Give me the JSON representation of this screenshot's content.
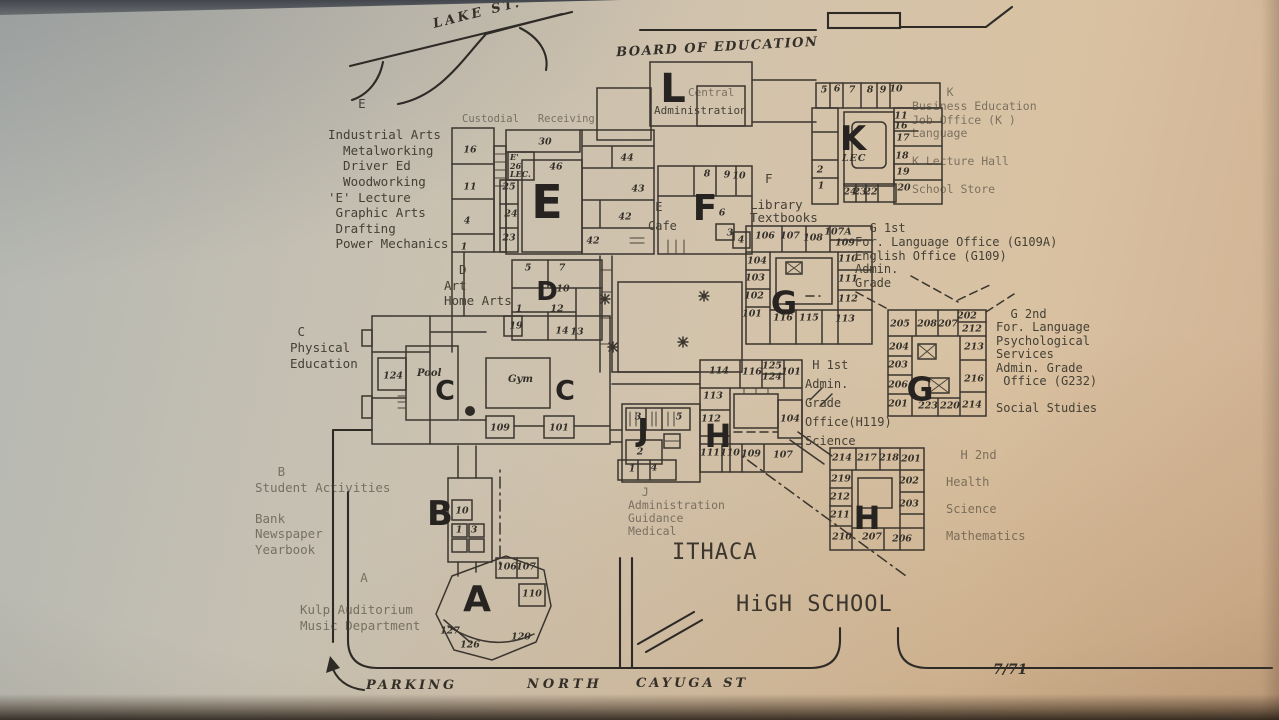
{
  "meta": {
    "date_stamp": "7/71",
    "map_subject": "Ithaca High School campus map"
  },
  "colors": {
    "paper": "#d3c3ab",
    "ink": "#3a352e",
    "shadow": "#2e2b27"
  },
  "annotations": [
    {
      "id": "lake-st-label",
      "x": 432,
      "y": 6,
      "size": 13,
      "ls": 3,
      "rot": -14,
      "cls": "hand",
      "lines": [
        "LAKE ST."
      ]
    },
    {
      "id": "board-of-education-label",
      "x": 616,
      "y": 40,
      "size": 13,
      "ls": 1.5,
      "rot": -3,
      "cls": "hand",
      "lines": [
        "BOARD OF EDUCATION"
      ]
    },
    {
      "id": "l-building-sublabel-top",
      "x": 688,
      "y": 86,
      "size": 11,
      "cls": "type faint",
      "lines": [
        "Central"
      ]
    },
    {
      "id": "l-building-sublabel-bottom",
      "x": 654,
      "y": 104,
      "size": 11,
      "cls": "type",
      "lines": [
        "Administration"
      ]
    },
    {
      "id": "custodial-label",
      "x": 462,
      "y": 113,
      "size": 10.5,
      "cls": "type faint",
      "lines": [
        "Custodial   Receiving"
      ]
    },
    {
      "id": "e-wing-legend",
      "x": 328,
      "y": 96,
      "size": 12.5,
      "lh": 15.6,
      "cls": "type",
      "lines": [
        "    E",
        "",
        "Industrial Arts",
        "  Metalworking",
        "  Driver Ed",
        "  Woodworking",
        "'E' Lecture",
        " Graphic Arts",
        " Drafting",
        " Power Mechanics"
      ]
    },
    {
      "id": "cafe-label",
      "x": 648,
      "y": 198,
      "size": 12,
      "lh": 19,
      "cls": "type",
      "lines": [
        " E",
        "Cafe"
      ]
    },
    {
      "id": "library-legend",
      "x": 750,
      "y": 172,
      "size": 12.5,
      "lh": 13,
      "cls": "type",
      "lines": [
        "  F",
        "",
        "Library",
        "Textbooks"
      ]
    },
    {
      "id": "k-legend",
      "x": 912,
      "y": 86,
      "size": 11.5,
      "lh": 13.8,
      "cls": "type faint",
      "lines": [
        "     K",
        "Business Education",
        "Job Office (K )",
        "Language",
        "",
        "K Lecture Hall",
        "",
        "School Store"
      ]
    },
    {
      "id": "g-first-legend",
      "x": 855,
      "y": 222,
      "size": 12,
      "lh": 13.8,
      "cls": "type",
      "lines": [
        "  G 1st",
        "For. Language Office (G109A)",
        "English Office (G109)",
        "Admin.",
        "Grade"
      ]
    },
    {
      "id": "g-second-legend",
      "x": 996,
      "y": 308,
      "size": 12,
      "lh": 13.4,
      "cls": "type",
      "lines": [
        "  G 2nd",
        "For. Language",
        "Psychological",
        "Services",
        "Admin. Grade",
        " Office (G232)",
        "",
        "Social Studies"
      ]
    },
    {
      "id": "h-first-legend",
      "x": 805,
      "y": 356,
      "size": 12,
      "lh": 19,
      "cls": "type",
      "lines": [
        " H 1st",
        "Admin.",
        "Grade",
        "Office(H119)",
        "Science"
      ]
    },
    {
      "id": "h-second-legend",
      "x": 946,
      "y": 442,
      "size": 12,
      "lh": 27,
      "cls": "type faint",
      "lines": [
        "  H 2nd",
        "Health",
        "Science",
        "Mathematics"
      ]
    },
    {
      "id": "c-legend",
      "x": 290,
      "y": 324,
      "size": 12.5,
      "lh": 16,
      "cls": "type",
      "lines": [
        " C",
        "Physical",
        "Education"
      ]
    },
    {
      "id": "d-legend",
      "x": 444,
      "y": 262,
      "size": 12.5,
      "lh": 15.5,
      "cls": "type",
      "lines": [
        "  D",
        "Art",
        "Home Arts"
      ]
    },
    {
      "id": "b-legend",
      "x": 255,
      "y": 464,
      "size": 12.5,
      "lh": 15.5,
      "cls": "type faint",
      "lines": [
        "   B",
        "Student Activities",
        "",
        "Bank",
        "Newspaper",
        "Yearbook"
      ]
    },
    {
      "id": "a-legend",
      "x": 300,
      "y": 570,
      "size": 12.5,
      "lh": 16,
      "cls": "type faint",
      "lines": [
        "        A",
        "",
        "Kulp Auditorium",
        "Music Department"
      ]
    },
    {
      "id": "j-legend",
      "x": 628,
      "y": 486,
      "size": 11.5,
      "lh": 13,
      "cls": "type faint",
      "lines": [
        "  J",
        "Administration",
        "Guidance",
        "Medical"
      ]
    },
    {
      "id": "school-name-line1",
      "x": 672,
      "y": 540,
      "size": 22,
      "ls": 1,
      "cls": "big",
      "lines": [
        "ITHACA"
      ]
    },
    {
      "id": "school-name-line2",
      "x": 736,
      "y": 592,
      "size": 22,
      "ls": 1,
      "cls": "big",
      "lines": [
        "HiGH SCHOOL"
      ]
    },
    {
      "id": "parking-label",
      "x": 366,
      "y": 678,
      "size": 13,
      "ls": 3,
      "cls": "hand",
      "lines": [
        "PARKING"
      ]
    },
    {
      "id": "north-label",
      "x": 527,
      "y": 677,
      "size": 13,
      "ls": 4,
      "cls": "hand",
      "lines": [
        "NORTH"
      ]
    },
    {
      "id": "cayuga-st-label",
      "x": 636,
      "y": 676,
      "size": 13,
      "ls": 3,
      "cls": "hand",
      "lines": [
        "CAYUGA ST"
      ]
    },
    {
      "id": "date-stamp",
      "x": 993,
      "y": 662,
      "size": 14,
      "cls": "hand",
      "lines": [
        "7/71"
      ]
    },
    {
      "id": "pool-label",
      "x": 417,
      "y": 368,
      "size": 10,
      "cls": "hand",
      "lines": [
        "Pool"
      ]
    },
    {
      "id": "gym-label",
      "x": 508,
      "y": 374,
      "size": 10,
      "cls": "hand",
      "lines": [
        "Gym"
      ]
    },
    {
      "id": "e-lecture-room-label",
      "x": 510,
      "y": 153,
      "size": 8,
      "lh": 8.5,
      "cls": "hand",
      "lines": [
        "E'",
        "26",
        "LEC."
      ]
    },
    {
      "id": "k-lecture-room-label",
      "x": 842,
      "y": 153,
      "size": 9.5,
      "ls": 1,
      "cls": "hand",
      "lines": [
        "LEC"
      ]
    }
  ],
  "letters": [
    {
      "t": "L",
      "x": 673,
      "y": 89,
      "s": 40
    },
    {
      "t": "E",
      "x": 547,
      "y": 202,
      "s": 46
    },
    {
      "t": "F",
      "x": 705,
      "y": 209,
      "s": 36
    },
    {
      "t": "K",
      "x": 853,
      "y": 139,
      "s": 34
    },
    {
      "t": "D",
      "x": 547,
      "y": 292,
      "s": 26
    },
    {
      "t": "C",
      "x": 445,
      "y": 391,
      "s": 27
    },
    {
      "t": "C",
      "x": 565,
      "y": 391,
      "s": 27
    },
    {
      "t": "G",
      "x": 784,
      "y": 303,
      "s": 32
    },
    {
      "t": "H",
      "x": 718,
      "y": 436,
      "s": 32
    },
    {
      "t": "J",
      "x": 643,
      "y": 431,
      "s": 31
    },
    {
      "t": "B",
      "x": 440,
      "y": 514,
      "s": 34
    },
    {
      "t": "A",
      "x": 477,
      "y": 600,
      "s": 36
    },
    {
      "t": "G",
      "x": 920,
      "y": 389,
      "s": 33
    },
    {
      "t": "H",
      "x": 867,
      "y": 518,
      "s": 32
    }
  ],
  "rooms": [
    {
      "t": "16",
      "x": 470,
      "y": 150
    },
    {
      "t": "11",
      "x": 470,
      "y": 187
    },
    {
      "t": "4",
      "x": 467,
      "y": 221
    },
    {
      "t": "1",
      "x": 464,
      "y": 247
    },
    {
      "t": "30",
      "x": 545,
      "y": 142
    },
    {
      "t": "25",
      "x": 509,
      "y": 187
    },
    {
      "t": "24",
      "x": 511,
      "y": 214
    },
    {
      "t": "23",
      "x": 509,
      "y": 238
    },
    {
      "t": "46",
      "x": 556,
      "y": 167
    },
    {
      "t": "44",
      "x": 627,
      "y": 158
    },
    {
      "t": "43",
      "x": 638,
      "y": 189
    },
    {
      "t": "42",
      "x": 625,
      "y": 217
    },
    {
      "t": "42",
      "x": 593,
      "y": 241
    },
    {
      "t": "5",
      "x": 528,
      "y": 268
    },
    {
      "t": "7",
      "x": 562,
      "y": 268
    },
    {
      "t": "10",
      "x": 563,
      "y": 289
    },
    {
      "t": "1",
      "x": 519,
      "y": 309
    },
    {
      "t": "12",
      "x": 557,
      "y": 309
    },
    {
      "t": "19",
      "x": 516,
      "y": 326
    },
    {
      "t": "14",
      "x": 562,
      "y": 331
    },
    {
      "t": "13",
      "x": 577,
      "y": 332
    },
    {
      "t": "8",
      "x": 707,
      "y": 174
    },
    {
      "t": "9",
      "x": 727,
      "y": 175
    },
    {
      "t": "10",
      "x": 739,
      "y": 176
    },
    {
      "t": "6",
      "x": 722,
      "y": 213
    },
    {
      "t": "3",
      "x": 730,
      "y": 233
    },
    {
      "t": "4",
      "x": 741,
      "y": 240
    },
    {
      "t": "5",
      "x": 824,
      "y": 90
    },
    {
      "t": "6",
      "x": 837,
      "y": 89
    },
    {
      "t": "7",
      "x": 852,
      "y": 90
    },
    {
      "t": "8",
      "x": 870,
      "y": 90
    },
    {
      "t": "9",
      "x": 883,
      "y": 90
    },
    {
      "t": "10",
      "x": 896,
      "y": 89
    },
    {
      "t": "2",
      "x": 820,
      "y": 170
    },
    {
      "t": "1",
      "x": 821,
      "y": 186
    },
    {
      "t": "11",
      "x": 901,
      "y": 116
    },
    {
      "t": "16",
      "x": 901,
      "y": 126
    },
    {
      "t": "17",
      "x": 903,
      "y": 138
    },
    {
      "t": "18",
      "x": 902,
      "y": 156
    },
    {
      "t": "19",
      "x": 903,
      "y": 172
    },
    {
      "t": "20",
      "x": 904,
      "y": 188
    },
    {
      "t": "24",
      "x": 850,
      "y": 192
    },
    {
      "t": "23",
      "x": 860,
      "y": 192
    },
    {
      "t": "22",
      "x": 871,
      "y": 192
    },
    {
      "t": "106",
      "x": 765,
      "y": 236
    },
    {
      "t": "107",
      "x": 790,
      "y": 236
    },
    {
      "t": "108",
      "x": 813,
      "y": 238
    },
    {
      "t": "107A",
      "x": 838,
      "y": 232
    },
    {
      "t": "109",
      "x": 845,
      "y": 243
    },
    {
      "t": "110",
      "x": 848,
      "y": 259
    },
    {
      "t": "104",
      "x": 757,
      "y": 261
    },
    {
      "t": "103",
      "x": 755,
      "y": 278
    },
    {
      "t": "111",
      "x": 848,
      "y": 279
    },
    {
      "t": "102",
      "x": 754,
      "y": 296
    },
    {
      "t": "112",
      "x": 848,
      "y": 299
    },
    {
      "t": "101",
      "x": 752,
      "y": 314
    },
    {
      "t": "116",
      "x": 783,
      "y": 318
    },
    {
      "t": "115",
      "x": 809,
      "y": 318
    },
    {
      "t": "113",
      "x": 845,
      "y": 319
    },
    {
      "t": "114",
      "x": 719,
      "y": 371
    },
    {
      "t": "116",
      "x": 752,
      "y": 372
    },
    {
      "t": "125",
      "x": 772,
      "y": 366
    },
    {
      "t": "124",
      "x": 772,
      "y": 377
    },
    {
      "t": "101",
      "x": 791,
      "y": 372
    },
    {
      "t": "113",
      "x": 713,
      "y": 396
    },
    {
      "t": "112",
      "x": 711,
      "y": 419
    },
    {
      "t": "104",
      "x": 790,
      "y": 419
    },
    {
      "t": "111",
      "x": 710,
      "y": 453
    },
    {
      "t": "110",
      "x": 730,
      "y": 453
    },
    {
      "t": "109",
      "x": 751,
      "y": 454
    },
    {
      "t": "107",
      "x": 783,
      "y": 455
    },
    {
      "t": "3",
      "x": 638,
      "y": 417
    },
    {
      "t": "5",
      "x": 679,
      "y": 417
    },
    {
      "t": "2",
      "x": 640,
      "y": 452
    },
    {
      "t": "1",
      "x": 632,
      "y": 469
    },
    {
      "t": "4",
      "x": 654,
      "y": 468
    },
    {
      "t": "124",
      "x": 393,
      "y": 376
    },
    {
      "t": "109",
      "x": 500,
      "y": 428
    },
    {
      "t": "101",
      "x": 559,
      "y": 428
    },
    {
      "t": "10",
      "x": 462,
      "y": 511
    },
    {
      "t": "1",
      "x": 459,
      "y": 530
    },
    {
      "t": "3",
      "x": 474,
      "y": 530
    },
    {
      "t": "106",
      "x": 507,
      "y": 567
    },
    {
      "t": "107",
      "x": 526,
      "y": 567
    },
    {
      "t": "110",
      "x": 532,
      "y": 594
    },
    {
      "t": "127",
      "x": 450,
      "y": 631
    },
    {
      "t": "126",
      "x": 470,
      "y": 645
    },
    {
      "t": "120",
      "x": 521,
      "y": 637
    },
    {
      "t": "205",
      "x": 900,
      "y": 324
    },
    {
      "t": "208",
      "x": 927,
      "y": 324
    },
    {
      "t": "207",
      "x": 948,
      "y": 324
    },
    {
      "t": "202",
      "x": 967,
      "y": 316
    },
    {
      "t": "212",
      "x": 972,
      "y": 329
    },
    {
      "t": "204",
      "x": 899,
      "y": 347
    },
    {
      "t": "203",
      "x": 898,
      "y": 365
    },
    {
      "t": "206",
      "x": 898,
      "y": 385
    },
    {
      "t": "201",
      "x": 898,
      "y": 404
    },
    {
      "t": "213",
      "x": 974,
      "y": 347
    },
    {
      "t": "216",
      "x": 974,
      "y": 379
    },
    {
      "t": "214",
      "x": 972,
      "y": 405
    },
    {
      "t": "223",
      "x": 928,
      "y": 406
    },
    {
      "t": "220",
      "x": 950,
      "y": 406
    },
    {
      "t": "214",
      "x": 842,
      "y": 458
    },
    {
      "t": "217",
      "x": 867,
      "y": 458
    },
    {
      "t": "218",
      "x": 889,
      "y": 458
    },
    {
      "t": "201",
      "x": 911,
      "y": 459
    },
    {
      "t": "219",
      "x": 841,
      "y": 479
    },
    {
      "t": "202",
      "x": 909,
      "y": 481
    },
    {
      "t": "212",
      "x": 840,
      "y": 497
    },
    {
      "t": "203",
      "x": 909,
      "y": 504
    },
    {
      "t": "211",
      "x": 840,
      "y": 515
    },
    {
      "t": "210",
      "x": 842,
      "y": 537
    },
    {
      "t": "207",
      "x": 872,
      "y": 537
    },
    {
      "t": "206",
      "x": 902,
      "y": 539
    }
  ]
}
